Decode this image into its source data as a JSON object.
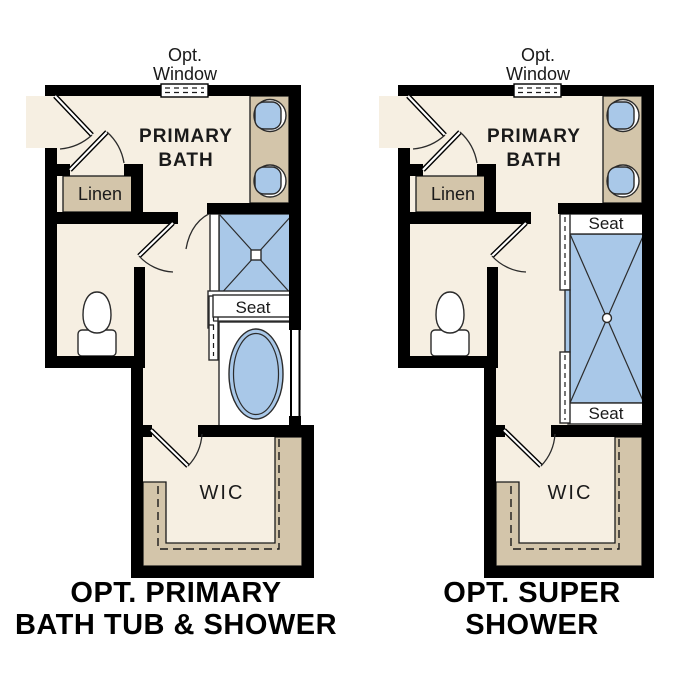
{
  "diagram_type": "floor-plan-options",
  "colors": {
    "background": "#FFFFFF",
    "floor": "#F6EFE2",
    "counter_tan": "#D3C5AA",
    "fixture_blue": "#A9C8E8",
    "wall": "#000000",
    "text": "#1A1A1A"
  },
  "plans": [
    {
      "name": "opt-primary-bath-tub-and-shower",
      "labels": {
        "opt": "Opt.",
        "window": "Window",
        "room1": "PRIMARY",
        "room2": "BATH",
        "linen": "Linen",
        "seat": "Seat",
        "wic": "WIC",
        "caption1": "OPT. PRIMARY",
        "caption2": "BATH TUB & SHOWER"
      },
      "features": [
        "double-sink vanity",
        "linen closet",
        "toilet",
        "shower with seat",
        "bath tub",
        "optional window",
        "walk-in closet"
      ]
    },
    {
      "name": "opt-super-shower",
      "labels": {
        "opt": "Opt.",
        "window": "Window",
        "room1": "PRIMARY",
        "room2": "BATH",
        "linen": "Linen",
        "seat_top": "Seat",
        "seat_bottom": "Seat",
        "wic": "WIC",
        "caption1": "OPT. SUPER",
        "caption2": "SHOWER"
      },
      "features": [
        "double-sink vanity",
        "linen closet",
        "toilet",
        "super shower with two seats",
        "optional window",
        "walk-in closet"
      ]
    }
  ]
}
